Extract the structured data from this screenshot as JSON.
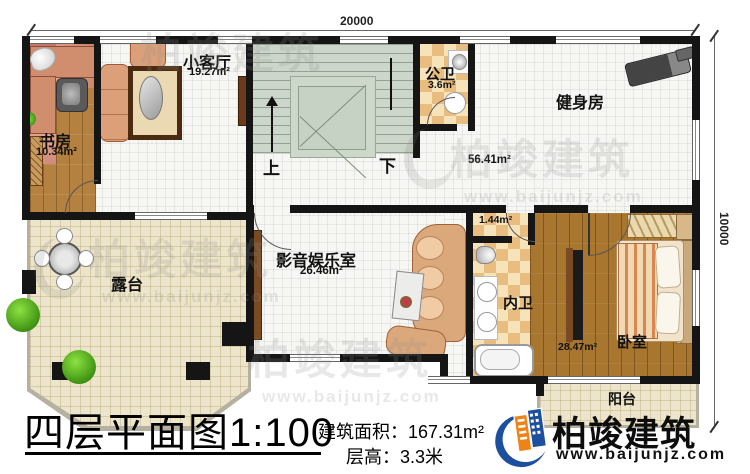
{
  "dimensions": {
    "top": "20000",
    "right": "10000"
  },
  "rooms": {
    "study": {
      "name": "书房",
      "area": "10.34m²"
    },
    "living": {
      "name": "小客厅",
      "area": "19.27m²"
    },
    "public_bath": {
      "name": "公卫",
      "area": "3.6m²"
    },
    "gym": {
      "name": "健身房",
      "area": "56.41m²"
    },
    "av_room": {
      "name": "影音娱乐室",
      "area": "26.46m²"
    },
    "bath_nook": {
      "area": "1.44m²"
    },
    "inner_bath": {
      "name": "内卫"
    },
    "bedroom": {
      "name": "卧室",
      "area": "28.47m²"
    },
    "terrace": {
      "name": "露台"
    },
    "balcony": {
      "name": "阳台"
    }
  },
  "stairs": {
    "up": "上",
    "down": "下"
  },
  "footer": {
    "title": "四层平面图1:100",
    "building_area": "建筑面积：167.31m²",
    "floor_height": "层高：3.3米"
  },
  "logo": {
    "name": "柏竣建筑",
    "url": "www.baijunjz.com"
  },
  "watermark": {
    "name": "柏竣建筑",
    "url": "www.baijunjz.com"
  },
  "colors": {
    "logo_blue": "#1d4f9f",
    "logo_orange": "#ef8318",
    "wall": "#151515"
  }
}
